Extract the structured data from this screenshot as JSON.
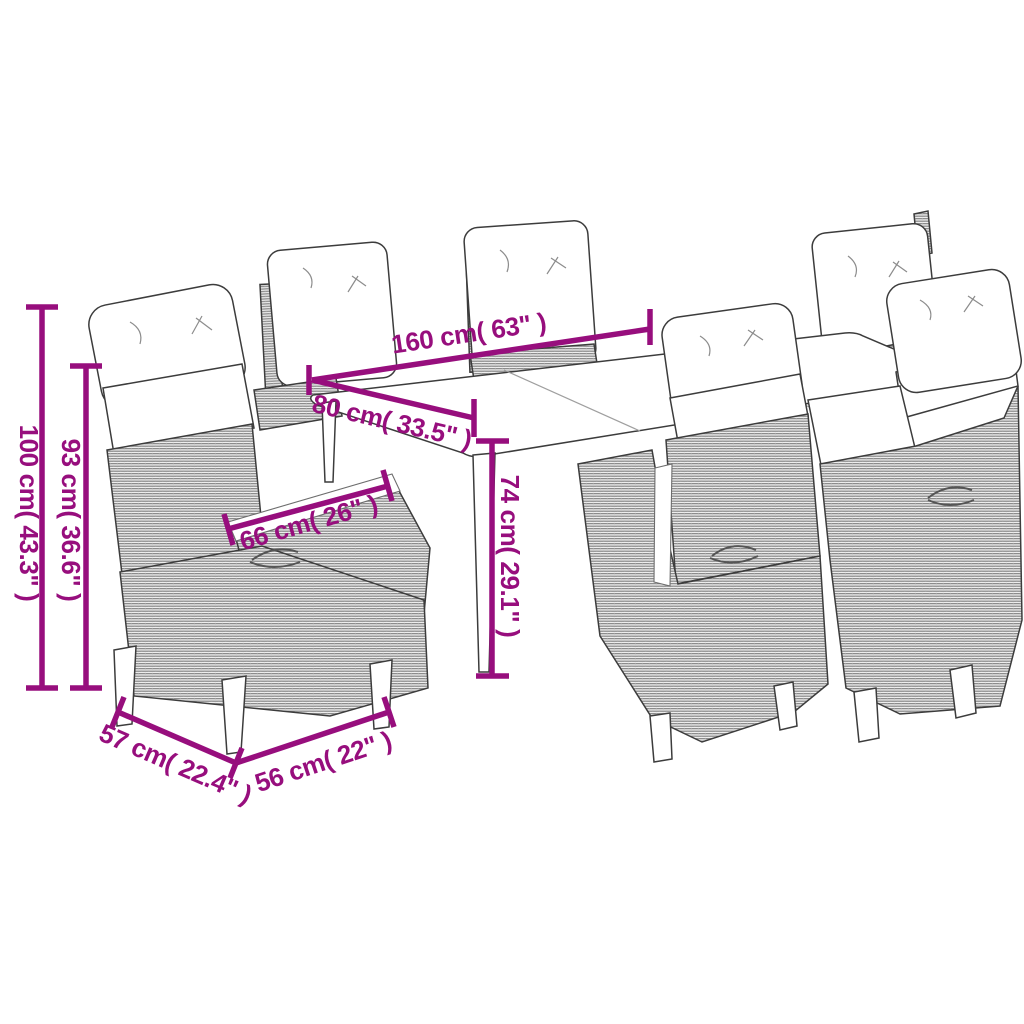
{
  "diagram": {
    "subject": "7-piece poly rattan garden dining set line drawing (table with 6 reclining chairs with cushions)",
    "style": "black-and-white line art with magenta dimension annotations",
    "background_color": "#ffffff",
    "accent_color": "#970E7D",
    "line_art_color": "#3C3C3C"
  },
  "dimensions": [
    {
      "name": "table-length",
      "label": "160 cm( 63\" )",
      "orientation": "diagonal-along-table-back-edge"
    },
    {
      "name": "table-depth",
      "label": "80 cm( 33.5\" )",
      "orientation": "diagonal-along-table-left-edge"
    },
    {
      "name": "table-height",
      "label": "74 cm( 29.1\" )",
      "orientation": "vertical-at-table-leg"
    },
    {
      "name": "chair-total-height",
      "label": "100 cm( 43.3\" )",
      "orientation": "vertical-left-outer"
    },
    {
      "name": "chair-back-height",
      "label": "93 cm( 36.6\" )",
      "orientation": "vertical-left-inner"
    },
    {
      "name": "chair-back-width",
      "label": "66 cm( 26\" )",
      "orientation": "diagonal-along-chair-backrest"
    },
    {
      "name": "chair-depth",
      "label": "57 cm( 22.4\" )",
      "orientation": "diagonal-bottom-left"
    },
    {
      "name": "chair-seat-width",
      "label": "56 cm( 22\" )",
      "orientation": "diagonal-bottom-right"
    }
  ]
}
